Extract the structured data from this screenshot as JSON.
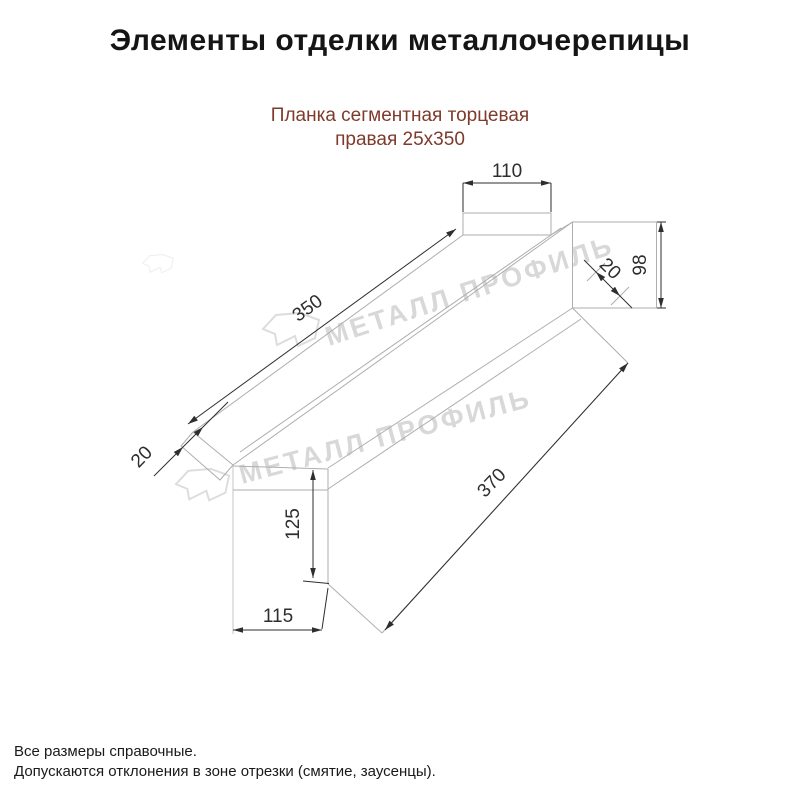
{
  "page": {
    "title": "Элементы отделки металлочерепицы"
  },
  "product": {
    "name_line1": "Планка сегментная торцевая",
    "name_line2": "правая 25х350"
  },
  "drawing": {
    "dimensions": {
      "top_flange_width": "110",
      "upper_flange_length": "350",
      "left_fold": "20",
      "right_end_height": "98",
      "right_fold": "20",
      "left_end_height": "125",
      "left_end_width": "115",
      "lower_flange_length": "370"
    },
    "watermark_text": "МЕТАЛЛ ПРОФИЛЬ",
    "colors": {
      "outline": "#aeaeae",
      "dimension": "#2e2e2e",
      "watermark": "#d8d8d8",
      "subtitle_accent": "#7e3a2b"
    }
  },
  "footer": {
    "line1": "Все размеры справочные.",
    "line2": "Допускаются отклонения в зоне отрезки (смятие, заусенцы)."
  }
}
